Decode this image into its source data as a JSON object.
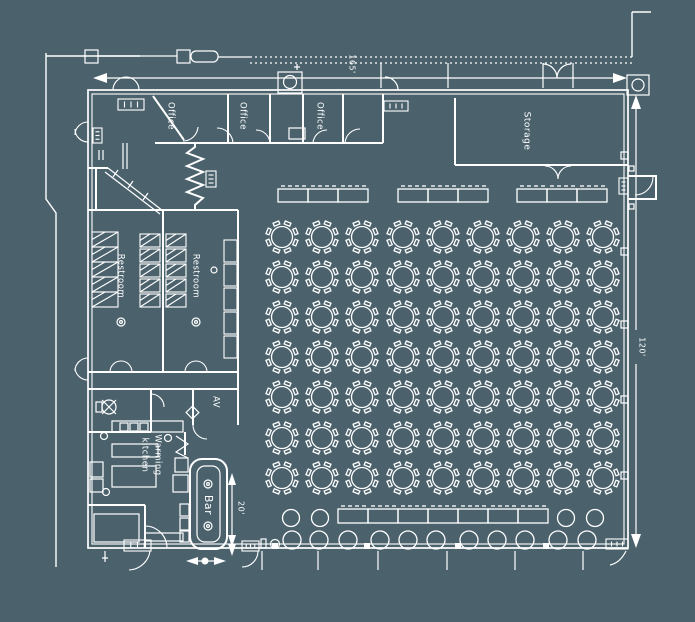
{
  "plan": {
    "bg": "#4b626d",
    "ink": "#ffffff",
    "labels": {
      "office1": "Office",
      "office2": "Office",
      "office3": "Office",
      "storage": "Storage",
      "restroom1": "Restroom",
      "restroom2": "Restroom",
      "av": "AV",
      "kitchen_line1": "Warming",
      "kitchen_line2": "kitchen",
      "bar": "Bar"
    },
    "dims": {
      "top_width": "165'",
      "right_height": "120'",
      "bar_depth": "20'"
    }
  },
  "furniture": {
    "round_tables": {
      "col_x": [
        282,
        322,
        362,
        403,
        443,
        483,
        523,
        563,
        603
      ],
      "row_y": [
        237,
        277,
        317,
        357,
        397,
        438,
        478
      ],
      "radius": 10.5,
      "chair_dist": 14.5,
      "chairs_per_table": 8,
      "count": 63
    },
    "buffet_top": {
      "group_x": [
        278,
        398,
        517
      ],
      "tables_per_group": 3,
      "table_w": 30,
      "table_h": 13,
      "y": 189
    },
    "buffet_bottom": {
      "x": 338,
      "count": 7,
      "table_w": 30,
      "table_h": 14,
      "y": 509
    },
    "cocktail_tables": {
      "points": [
        [
          291,
          518
        ],
        [
          320,
          518
        ],
        [
          566,
          518
        ],
        [
          595,
          518
        ]
      ],
      "radius": 8.5
    },
    "chair_row_bottom": {
      "x": [
        292,
        319,
        348,
        380,
        408,
        436,
        469,
        497,
        525,
        558,
        587
      ],
      "y": 540,
      "radius": 9
    },
    "wall_posts_bottom": {
      "x": [
        272,
        364,
        455,
        543
      ],
      "y": 543,
      "size": 6
    },
    "wall_posts_right": {
      "x": 621,
      "y": [
        152,
        248,
        321,
        396,
        472
      ],
      "size": 7
    },
    "stall_banks": [
      {
        "x": 92,
        "y": 232,
        "w": 26,
        "h": 15,
        "count": 5,
        "step": 15,
        "hatch": true
      },
      {
        "x": 140,
        "y": 234,
        "w": 20,
        "h": 13,
        "count": 5,
        "step": 15,
        "hatch": true
      },
      {
        "x": 166,
        "y": 234,
        "w": 20,
        "h": 13,
        "count": 5,
        "step": 15,
        "hatch": true
      },
      {
        "x": 224,
        "y": 240,
        "w": 13,
        "h": 22,
        "count": 5,
        "step": 24,
        "hatch": false
      }
    ],
    "exit_signs": [
      {
        "x": 118,
        "y": 99,
        "w": 26,
        "h": 11,
        "o": "h"
      },
      {
        "x": 384,
        "y": 101,
        "w": 24,
        "h": 10,
        "o": "h"
      },
      {
        "x": 93,
        "y": 128,
        "w": 9,
        "h": 15,
        "o": "v"
      },
      {
        "x": 206,
        "y": 171,
        "w": 10,
        "h": 16,
        "o": "v"
      },
      {
        "x": 619,
        "y": 178,
        "w": 9,
        "h": 16,
        "o": "v"
      },
      {
        "x": 124,
        "y": 540,
        "w": 27,
        "h": 11,
        "o": "h"
      },
      {
        "x": 242,
        "y": 541,
        "w": 17,
        "h": 10,
        "o": "h"
      },
      {
        "x": 606,
        "y": 539,
        "w": 22,
        "h": 10,
        "o": "h"
      }
    ]
  }
}
